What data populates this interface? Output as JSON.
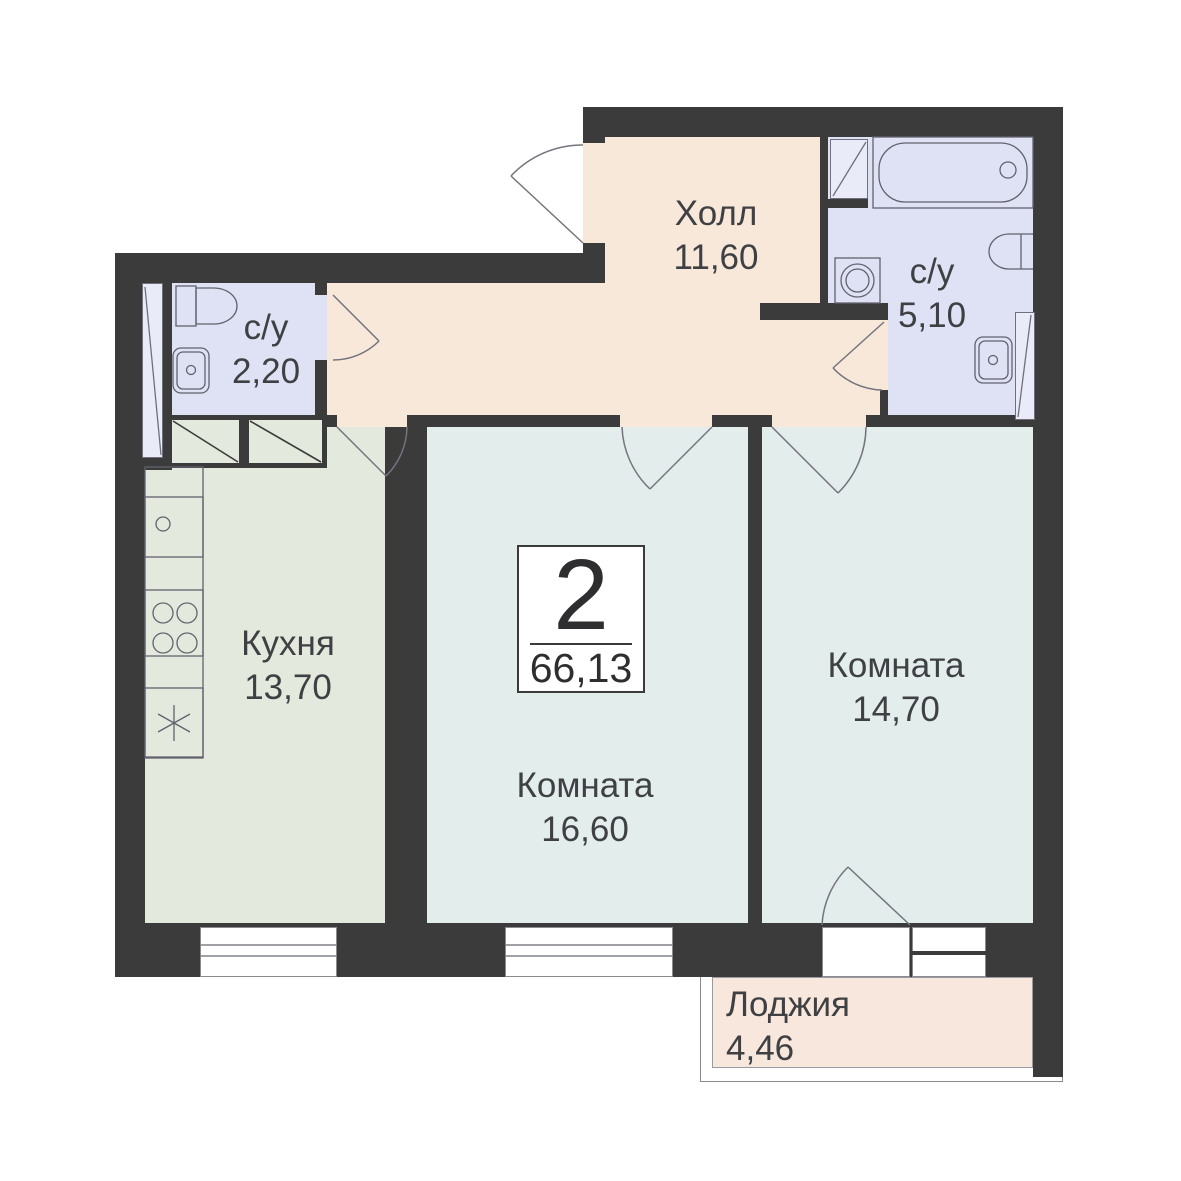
{
  "plan": {
    "type": "apartment-floor-plan",
    "badge": {
      "rooms_count": "2",
      "total_area": "66,13"
    },
    "rooms": {
      "hall": {
        "name": "Холл",
        "area": "11,60"
      },
      "bath_small": {
        "name": "с/у",
        "area": "2,20"
      },
      "bath_big": {
        "name": "с/у",
        "area": "5,10"
      },
      "kitchen": {
        "name": "Кухня",
        "area": "13,70"
      },
      "living_room_1": {
        "name": "Комната",
        "area": "16,60"
      },
      "living_room_2": {
        "name": "Комната",
        "area": "14,70"
      },
      "loggia": {
        "name": "Лоджия",
        "area": "4,46"
      }
    },
    "colors": {
      "wall": "#3B3B3C",
      "hall_floor": "#F8E8DA",
      "bathroom_floor": "#DFE2F4",
      "kitchen_floor": "#E3E9DD",
      "room_floor": "#E3EDEB",
      "loggia_floor": "#F7E7DC",
      "fixture_outline": "#62626E",
      "text": "#3F4043"
    },
    "fixtures": [
      "bathtub",
      "washing-machine",
      "toilet",
      "sink",
      "kitchen-sink",
      "stove",
      "fridge",
      "ventilation-shaft"
    ]
  }
}
